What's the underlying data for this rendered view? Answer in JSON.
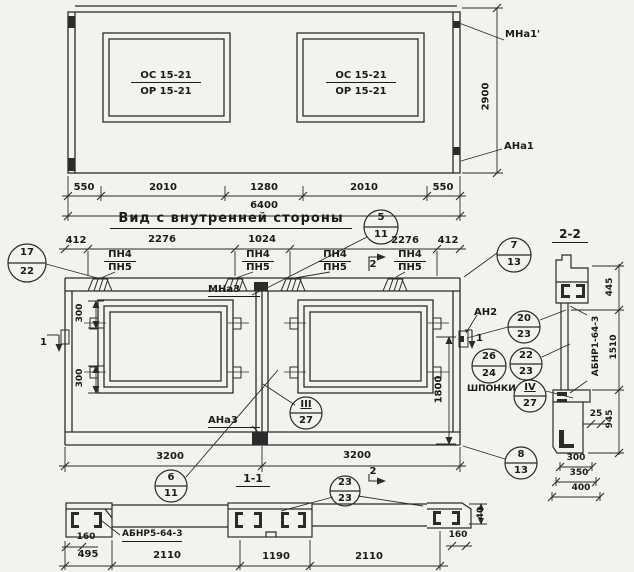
{
  "colors": {
    "paper": "#f4f2ee",
    "ink": "#1b1b1b"
  },
  "outside_view": {
    "window_mark_line1": "ОС 15-21",
    "window_mark_line2": "ОР 15-21",
    "anchor_top_right": "МНа1'",
    "anchor_bottom_right": "АНа1",
    "dim_height": "2900",
    "dims_bottom": [
      "550",
      "2010",
      "1280",
      "2010",
      "550"
    ],
    "dim_total": "6400"
  },
  "inner_view": {
    "title": "Вид с внутренней стороны",
    "dims_top": [
      "412",
      "2276",
      "1024",
      "2276",
      "412"
    ],
    "hinge_label_top": "ПН4",
    "hinge_label_bottom": "ПН5",
    "anchor_mna3": "МНа3",
    "anchor_ana3": "АНа3",
    "anchor_an2": "АН2",
    "keys_label": "ШПОНКИ",
    "dim_300_upper": "300",
    "dim_300_lower": "300",
    "dim_1800": "1800",
    "dim_3200_left": "3200",
    "dim_3200_right": "3200",
    "section1_mark": "1",
    "section2_mark": "2"
  },
  "callouts": {
    "c17": {
      "num": "17",
      "sheet": "22"
    },
    "c5": {
      "num": "5",
      "sheet": "11"
    },
    "c7": {
      "num": "7",
      "sheet": "13"
    },
    "c20": {
      "num": "20",
      "sheet": "23"
    },
    "c26": {
      "num": "26",
      "sheet": "24"
    },
    "c22": {
      "num": "22",
      "sheet": "23"
    },
    "c4r": {
      "num": "IV",
      "sheet": "27"
    },
    "c3r": {
      "num": "III",
      "sheet": "27"
    },
    "c6": {
      "num": "6",
      "sheet": "11"
    },
    "c8": {
      "num": "8",
      "sheet": "13"
    },
    "c23": {
      "num": "23",
      "sheet": "23"
    }
  },
  "section_2_2": {
    "title": "2-2",
    "profile_mark": "АБНР1-64-3",
    "dim_445": "445",
    "dim_1510": "1510",
    "dim_945": "945",
    "dim_25": "25",
    "dims_bottom": [
      "300",
      "350",
      "400"
    ]
  },
  "section_1_1": {
    "title": "1-1",
    "profile_mark": "АБНР5-64-3",
    "dim_160_left": "160",
    "dims_bottom": [
      "495",
      "2110",
      "1190",
      "2110"
    ],
    "dim_160_right": "160",
    "dim_40": "40"
  }
}
